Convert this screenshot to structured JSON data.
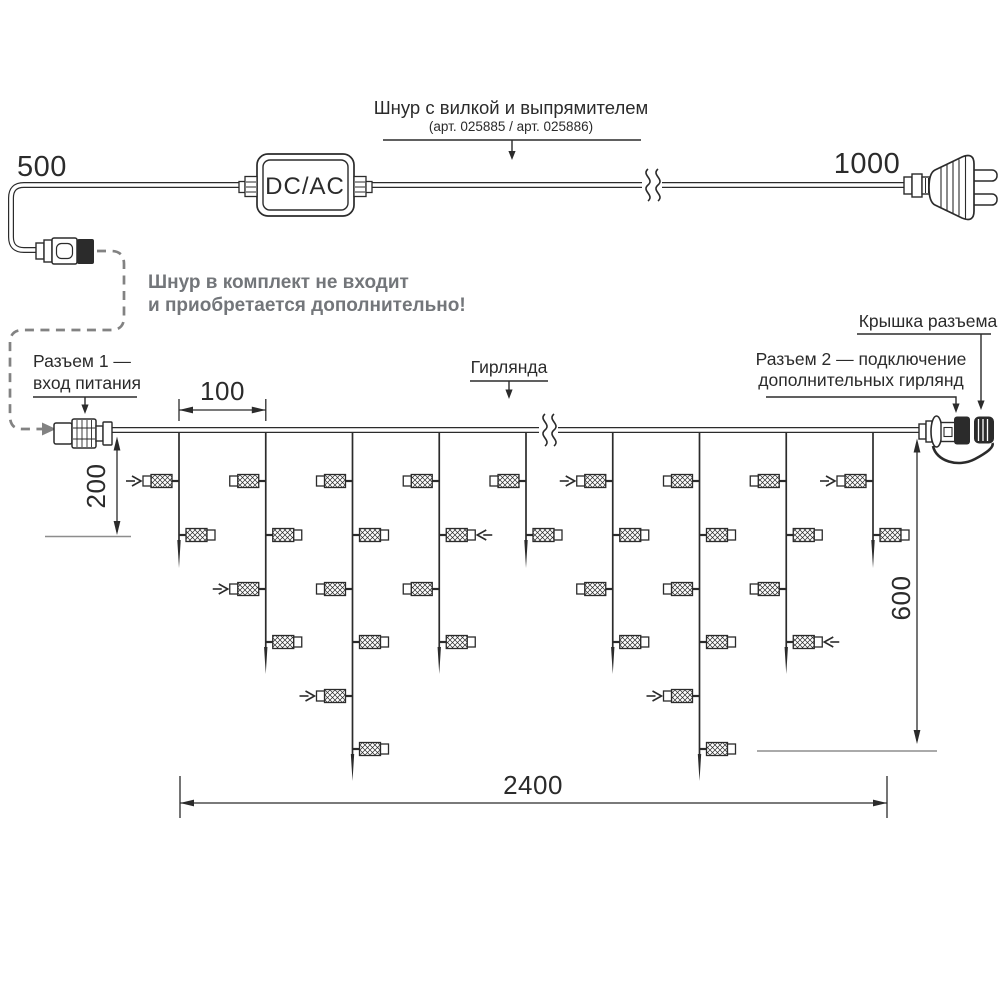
{
  "colors": {
    "ink": "#2b2b2b",
    "note_gray": "#73767a",
    "reference_gray": "#8d8d8d",
    "dash_gray": "#828282",
    "background": "#ffffff"
  },
  "power_cord": {
    "length_left_label": "500",
    "length_right_label": "1000",
    "converter_label": "DC/AC",
    "title_line1": "Шнур с вилкой и выпрямителем",
    "title_line2": "(арт. 025885 / арт. 025886)",
    "note_line1": "Шнур в комплект не входит",
    "note_line2": "и приобретается дополнительно!"
  },
  "garland": {
    "connector1_label_line1": "Разъем 1 —",
    "connector1_label_line2": "вход питания",
    "garland_label": "Гирлянда",
    "connector2_label_line1": "Разъем 2 — подключение",
    "connector2_label_line2": "дополнительных гирлянд",
    "cap_label": "Крышка разъема",
    "dims": {
      "drop_spacing": "100",
      "first_drop_length": "200",
      "max_drop_length": "600",
      "total_length": "2400"
    },
    "drops": [
      {
        "bulbs": 2,
        "flash": [
          {
            "level": 0,
            "side": "left"
          }
        ]
      },
      {
        "bulbs": 4,
        "flash": [
          {
            "level": 2,
            "side": "left"
          }
        ]
      },
      {
        "bulbs": 6,
        "flash": [
          {
            "level": 4,
            "side": "left"
          }
        ]
      },
      {
        "bulbs": 4,
        "flash": [
          {
            "level": 1,
            "side": "right"
          }
        ]
      },
      {
        "bulbs": 2,
        "flash": []
      },
      {
        "bulbs": 4,
        "flash": [
          {
            "level": 0,
            "side": "left"
          }
        ]
      },
      {
        "bulbs": 6,
        "flash": [
          {
            "level": 4,
            "side": "left"
          }
        ]
      },
      {
        "bulbs": 4,
        "flash": [
          {
            "level": 3,
            "side": "right"
          }
        ]
      },
      {
        "bulbs": 2,
        "flash": [
          {
            "level": 0,
            "side": "left"
          }
        ]
      }
    ]
  }
}
